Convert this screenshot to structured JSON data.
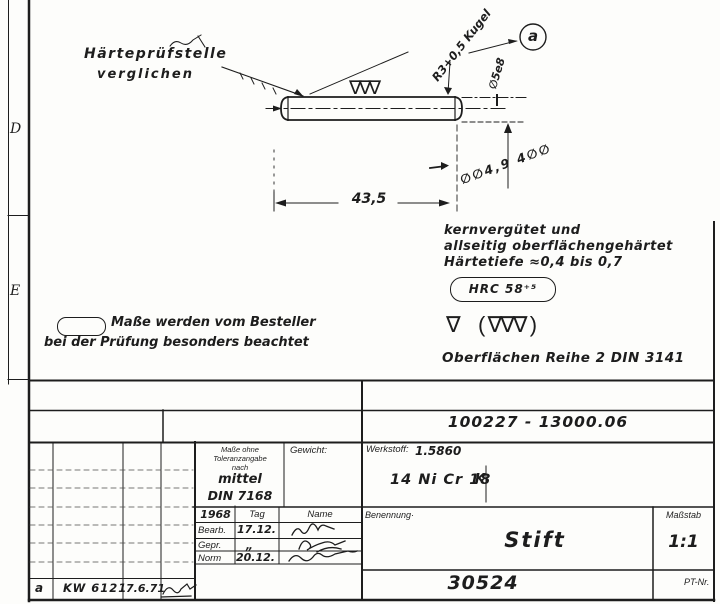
{
  "colors": {
    "ink": "#1d1d1d",
    "paper": "#fdfdfb"
  },
  "drawing": {
    "note_hardness_test": {
      "line1": "Härteprüfstelle",
      "line2": "verglichen"
    },
    "label_ball_radius": "R3+0,5 Kugel",
    "detail_marker": "a",
    "dim_diameter": "∅5e8",
    "dim_length": "43,5",
    "pencil_scribble": "∅∅4,9 4∅∅",
    "pin_surface_marks": "∇∇∇",
    "note_heat_treatment": {
      "line1": "kernvergütet und",
      "line2": "allseitig  oberflächengehärtet",
      "line3": "Härtetiefe ≈0,4 bis 0,7",
      "hardness": "HRC 58⁺⁵"
    },
    "surface_symbols": {
      "single": "∇",
      "group": "( ∇∇∇ )",
      "caption": "Oberflächen  Reihe 2 DIN 3141"
    },
    "note_inspection": {
      "line1": "Maße werden vom Besteller",
      "line2": "bei der Prüfung besonders beachtet"
    },
    "margin_rows": {
      "d": "D",
      "e": "E"
    }
  },
  "title_block": {
    "doc_number": "100227 - 13000.06",
    "tolerance": {
      "label1": "Maße ohne",
      "label2": "Toleranzangabe",
      "label3": "nach",
      "value1": "mittel",
      "value2": "DIN 7168"
    },
    "weight_label": "Gewicht:",
    "material": {
      "label": "Werkstoff:",
      "number": "1.5860",
      "name": "14 Ni Cr 18",
      "extra": "K"
    },
    "approval": {
      "year": "1968",
      "col_date": "Tag",
      "col_name": "Name",
      "rows": [
        {
          "label": "Bearb.",
          "date": "17.12."
        },
        {
          "label": "Gepr.",
          "date": "„"
        },
        {
          "label": "Norm",
          "date": "20.12."
        }
      ]
    },
    "name": {
      "label": "Benennung·",
      "value": "Stift"
    },
    "scale": {
      "label": "Maßstab",
      "value": "1:1"
    },
    "part_number": "30524",
    "pt_label": "PT-Nr.",
    "revision": {
      "rev": "a",
      "doc": "KW 6121",
      "date": "7.6.71"
    }
  }
}
